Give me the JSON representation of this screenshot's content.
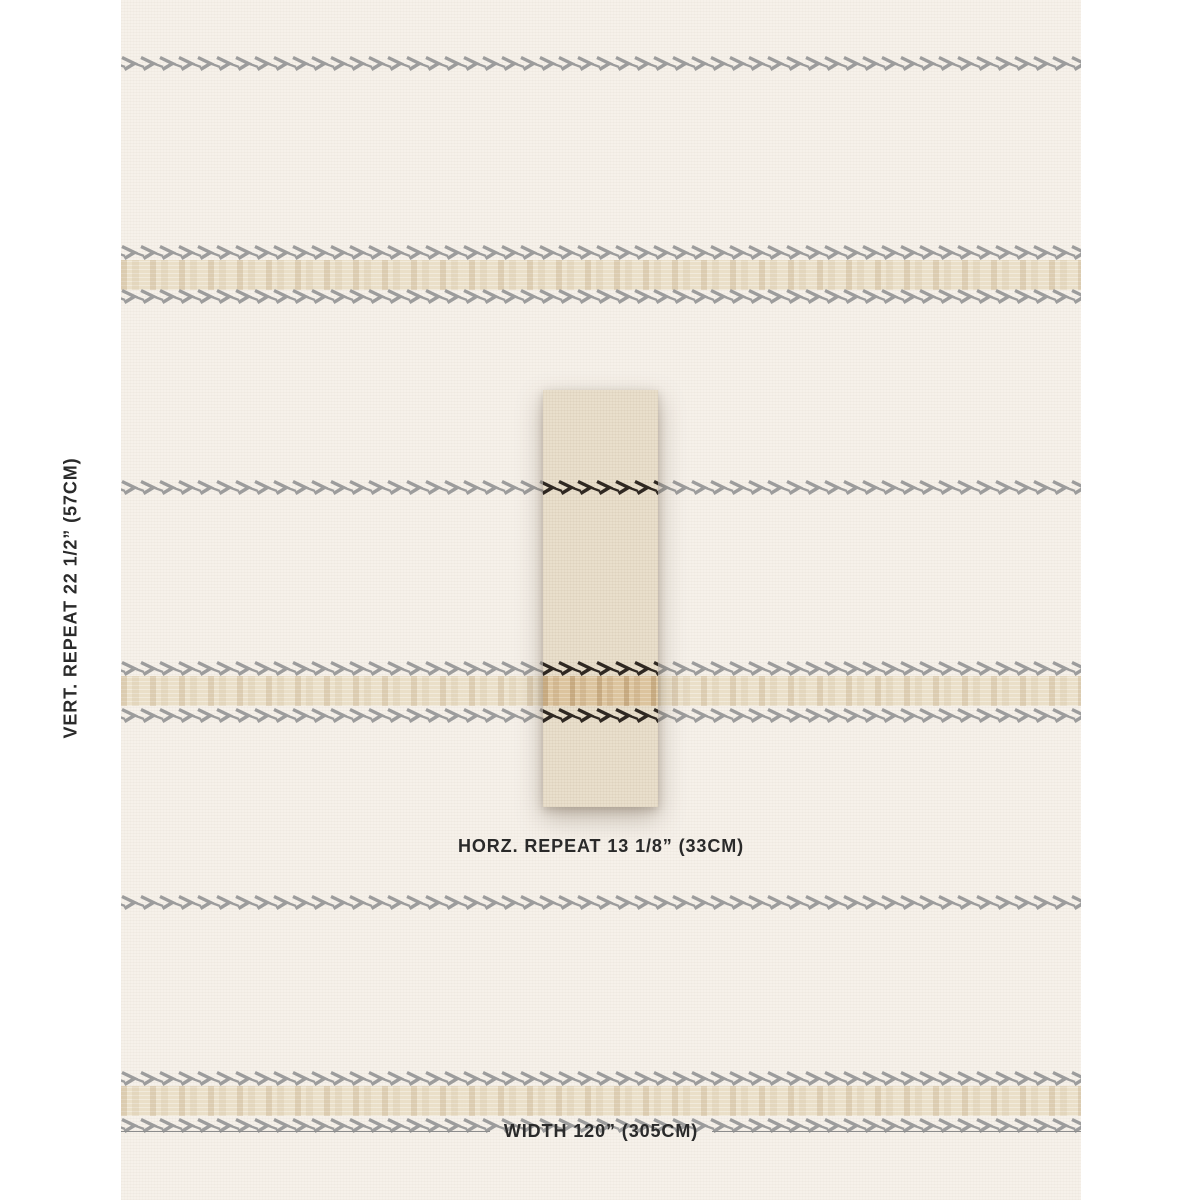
{
  "labels": {
    "vertical_repeat": "VERT. REPEAT 22 1/2” (57CM)",
    "horizontal_repeat": "HORZ. REPEAT 13 1/8” (33CM)",
    "width": "WIDTH 120” (305CM)"
  },
  "colors": {
    "page_background": "#ffffff",
    "fabric_base": "#f6f1ea",
    "fabric_band": "#eadfc8",
    "stripe_grey": "#9c9c9c",
    "swatch_base": "#e9dfcc",
    "swatch_stripe_dark": "#2f2822",
    "swatch_band": "#dcc49e",
    "label_text": "#2a2a2a",
    "width_line": "#8c8c8c"
  }
}
